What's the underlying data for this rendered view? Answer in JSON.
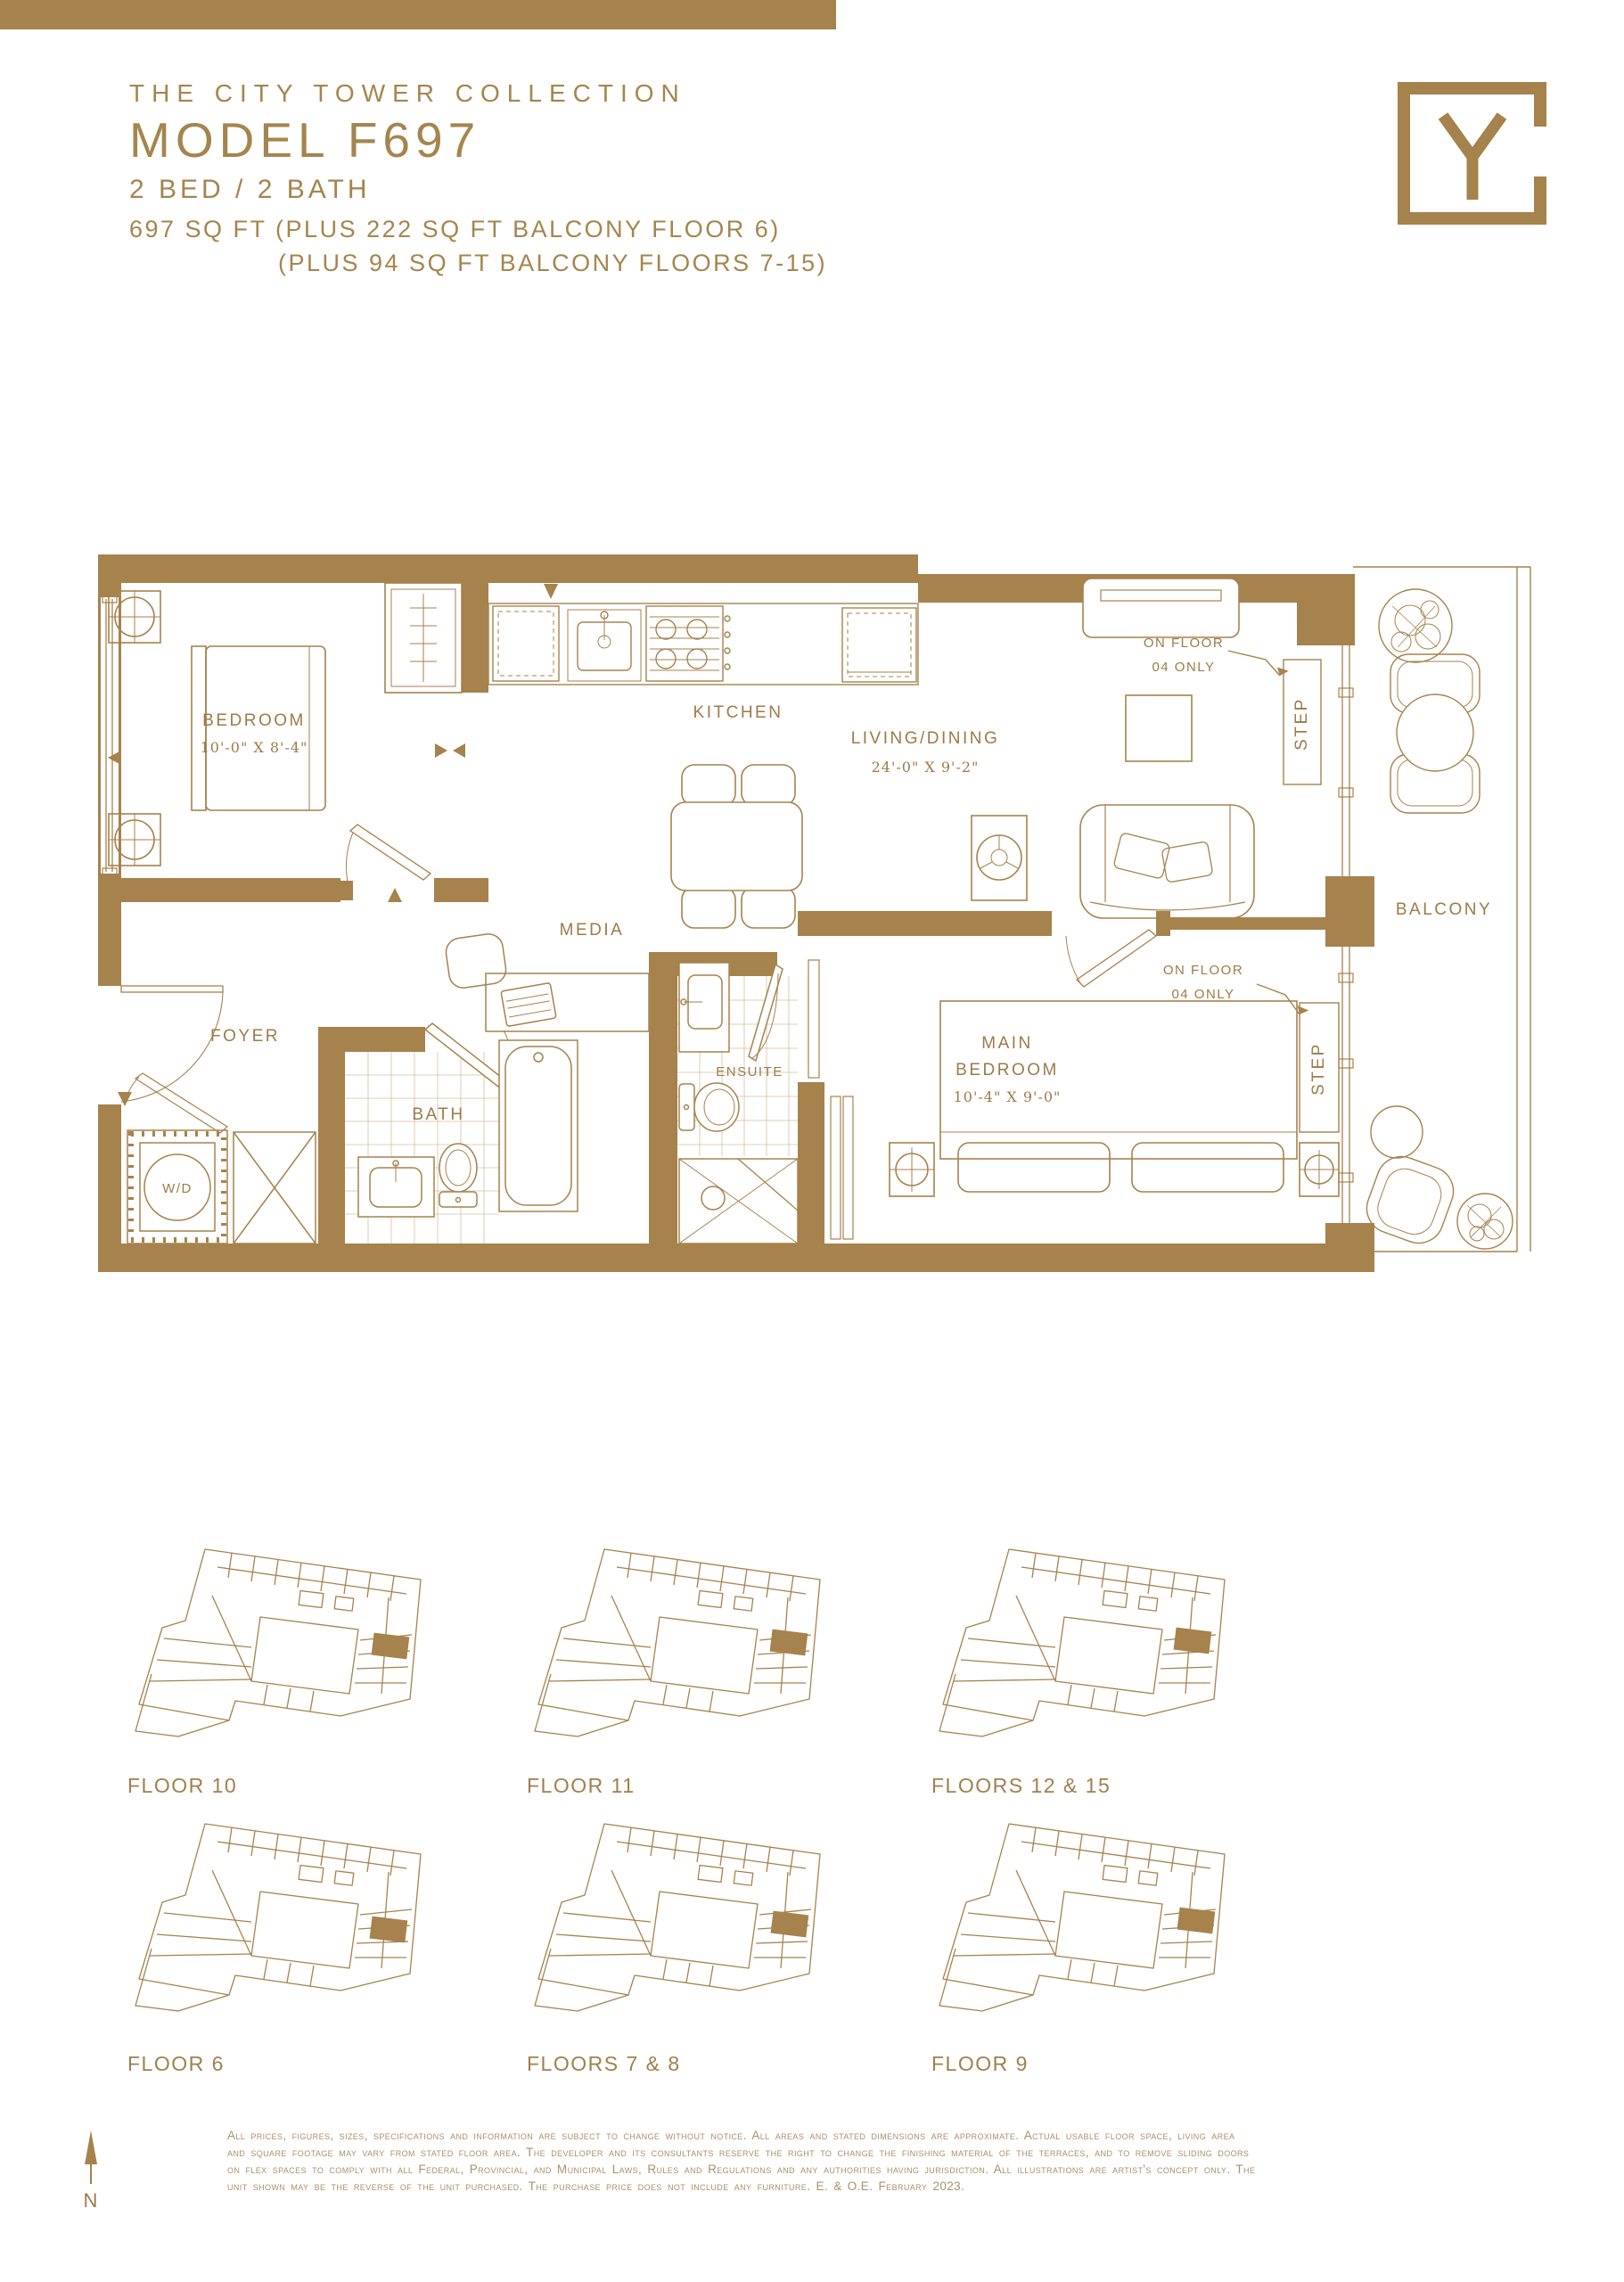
{
  "page": {
    "accent_gold": "#A6824D",
    "background": "#FFFFFF"
  },
  "header": {
    "collection_title": "THE CITY TOWER COLLECTION",
    "model_title": "MODEL F697",
    "bed_bath": "2 BED / 2 BATH",
    "area_line_1": "697 SQ FT (PLUS 222 SQ FT BALCONY FLOOR 6)",
    "area_line_2": "(PLUS 94 SQ FT BALCONY FLOORS 7-15)"
  },
  "logo": {
    "letter": "Y"
  },
  "plan": {
    "bedroom_label": "BEDROOM",
    "bedroom_dims": "10'-0\" X 8'-4\"",
    "kitchen_label": "KITCHEN",
    "living_label": "LIVING/DINING",
    "living_dims": "24'-0\" X 9'-2\"",
    "media_label": "MEDIA",
    "foyer_label": "FOYER",
    "bath_label": "BATH",
    "ensuite_label": "ENSUITE",
    "main_bedroom_label_1": "MAIN",
    "main_bedroom_label_2": "BEDROOM",
    "main_bedroom_dims": "10'-4\" X 9'-0\"",
    "balcony_label": "BALCONY",
    "wd_label": "W/D",
    "step_label": "STEP",
    "on_floor_line_1": "ON FLOOR",
    "on_floor_line_2": "04 ONLY"
  },
  "keyplates": [
    {
      "label": "FLOOR 10"
    },
    {
      "label": "FLOOR 11"
    },
    {
      "label": "FLOORS 12 & 15"
    },
    {
      "label": "FLOOR 6"
    },
    {
      "label": "FLOORS 7 & 8"
    },
    {
      "label": "FLOOR 9"
    }
  ],
  "compass": {
    "label": "N"
  },
  "disclaimer": {
    "line_1": "All prices, figures, sizes, specifications and information are subject to change without notice. All areas and stated dimensions are approximate. Actual usable floor space, living area",
    "line_2": "and square footage may vary from stated floor area. The developer and its consultants reserve the right to change the finishing material of the terraces, and to remove sliding doors",
    "line_3": "on flex spaces to comply with all Federal, Provincial, and Municipal Laws, Rules and Regulations and any authorities having jurisdiction. All illustrations are artist's concept only. The",
    "line_4": "unit shown may be the reverse of the unit purchased. The purchase price does not include any furniture. E. & O.E. February 2023."
  }
}
